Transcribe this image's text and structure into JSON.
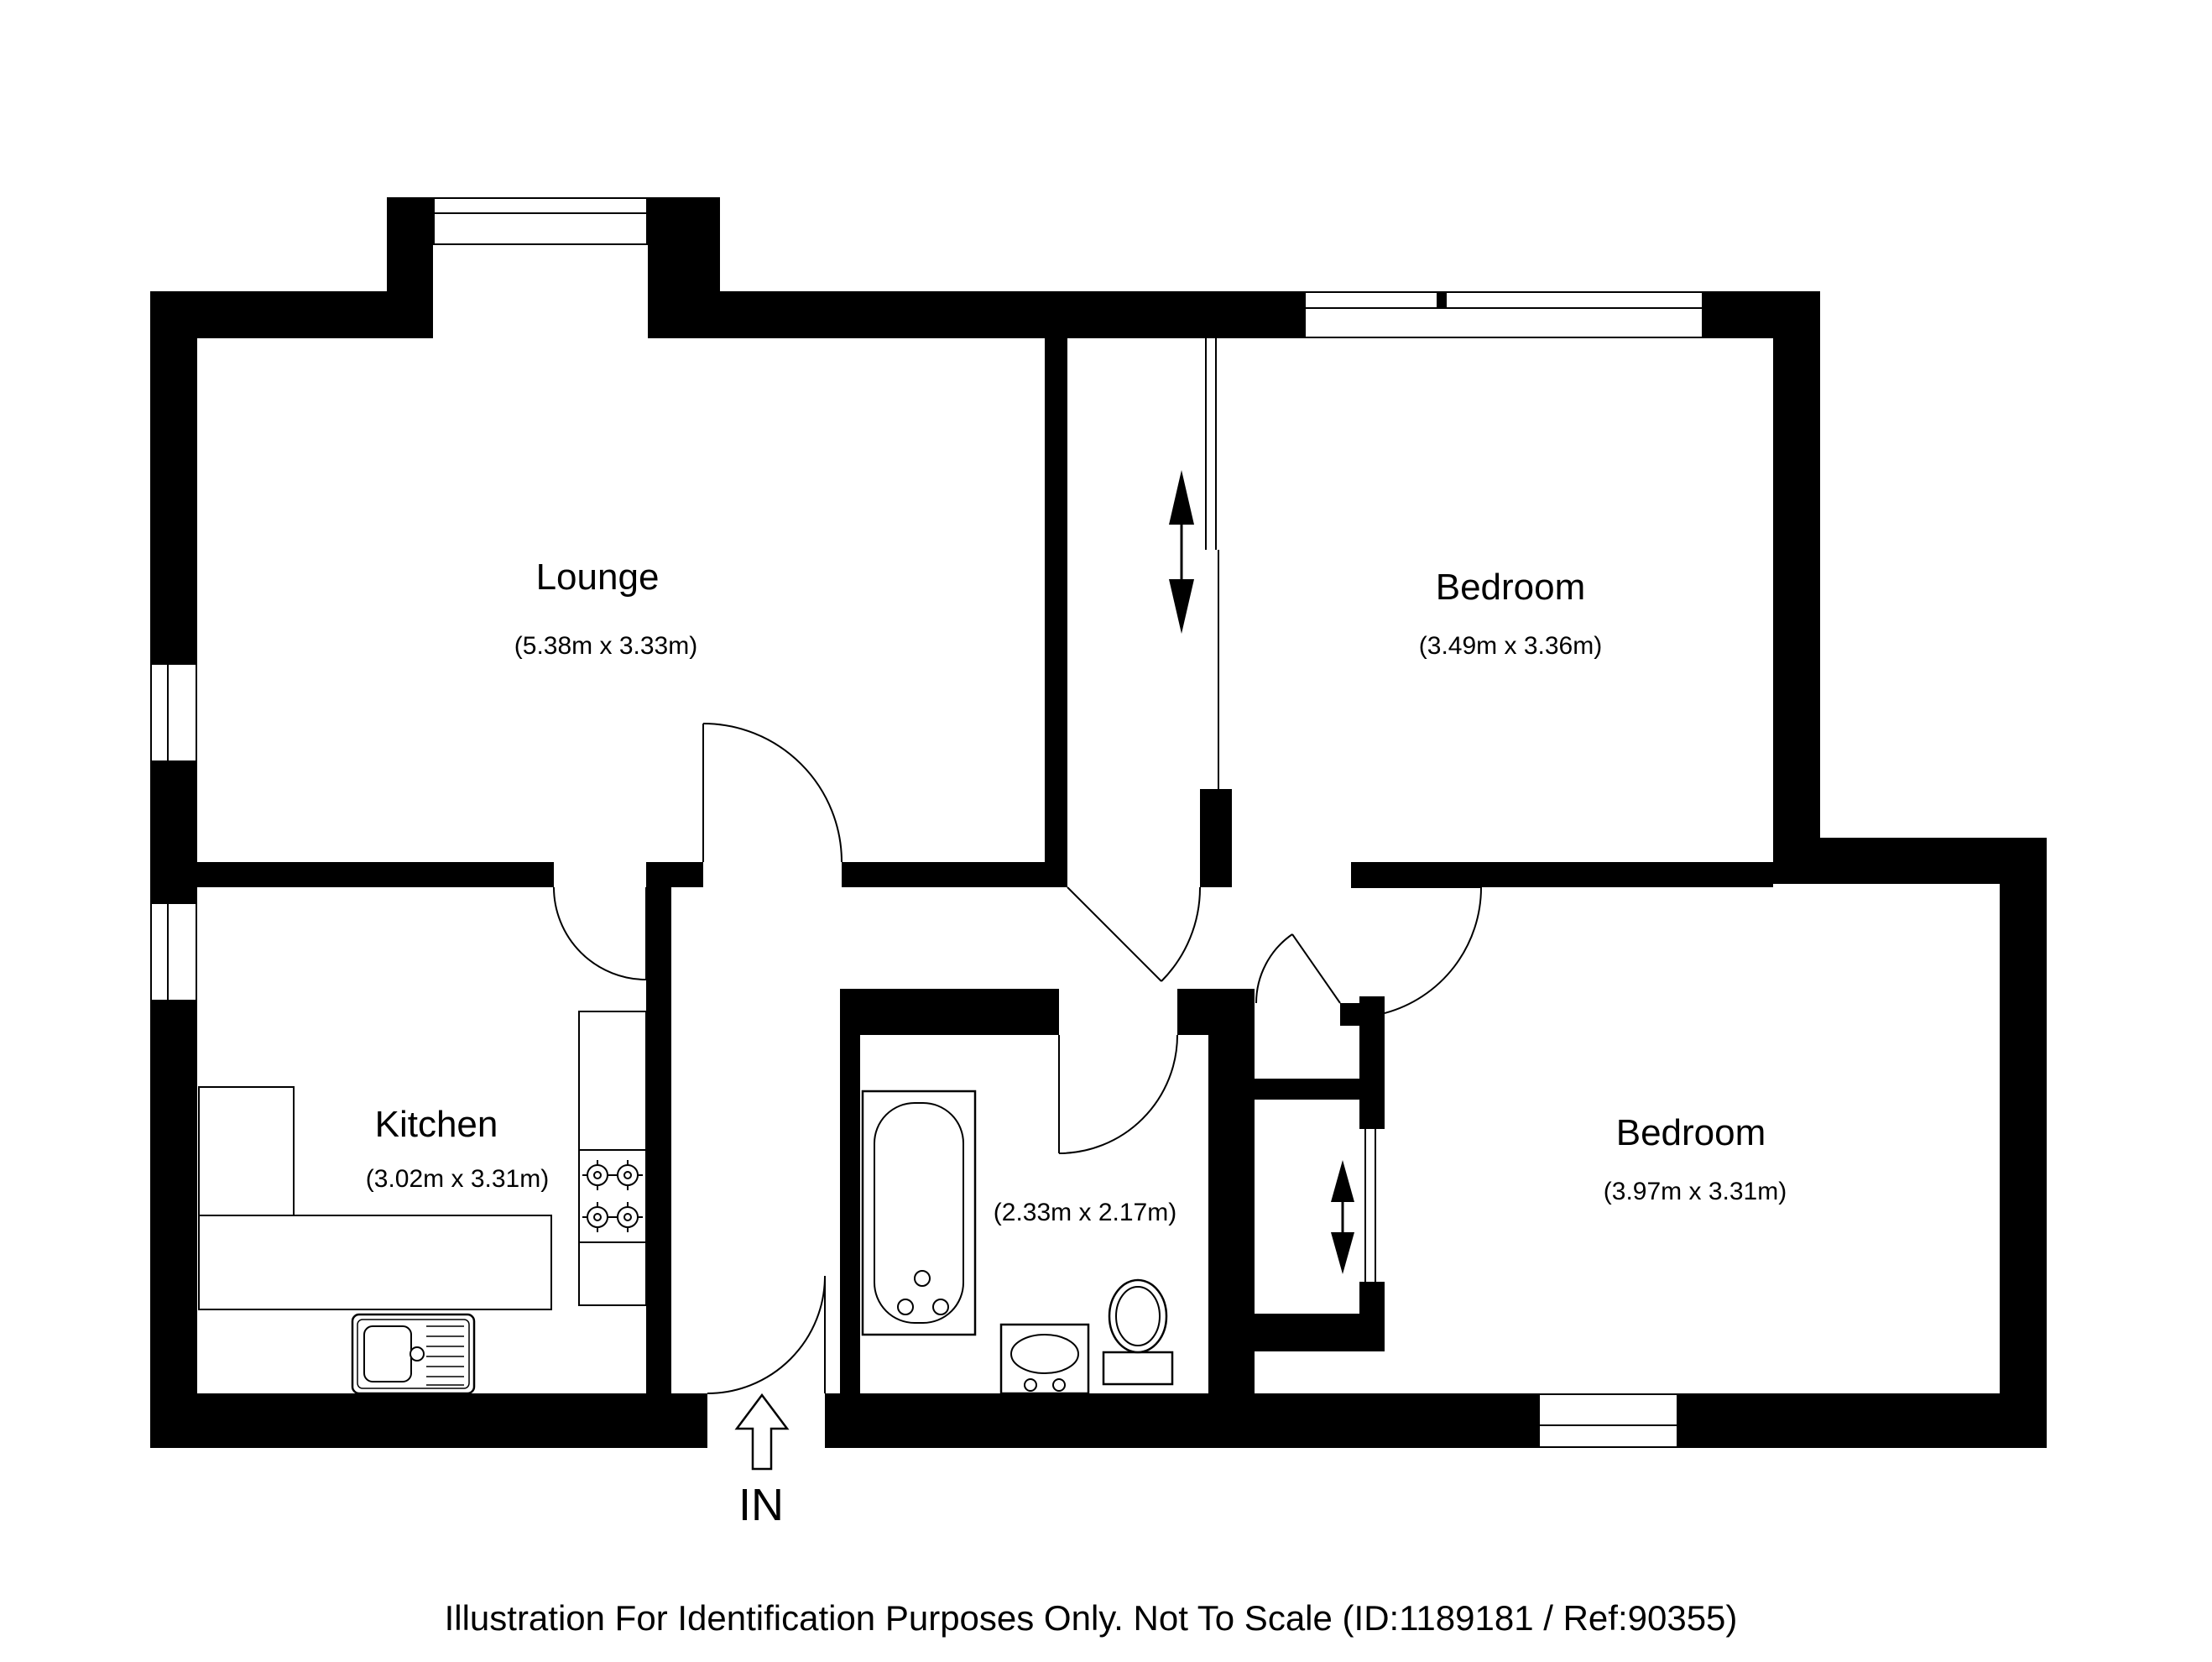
{
  "page": {
    "background": "#ffffff",
    "wall_color": "#000000",
    "line_color": "#000000"
  },
  "rooms": {
    "lounge": {
      "name": "Lounge",
      "dims": "(5.38m x 3.33m)"
    },
    "bedroom_top": {
      "name": "Bedroom",
      "dims": "(3.49m x 3.36m)"
    },
    "bedroom_bottom": {
      "name": "Bedroom",
      "dims": "(3.97m x 3.31m)"
    },
    "kitchen": {
      "name": "Kitchen",
      "dims": "(3.02m x 3.31m)"
    },
    "bathroom": {
      "dims": "(2.33m x 2.17m)"
    }
  },
  "entrance": {
    "label": "IN",
    "icon": "entry-arrow-up-icon"
  },
  "icons": {
    "entry_arrow": "outlined upward arrow at front door",
    "sliding_door_arrows": "filled up/down arrows marking sliding doors"
  },
  "footer": {
    "text": "Illustration For Identification Purposes Only. Not To Scale (ID:1189181 / Ref:90355)"
  }
}
